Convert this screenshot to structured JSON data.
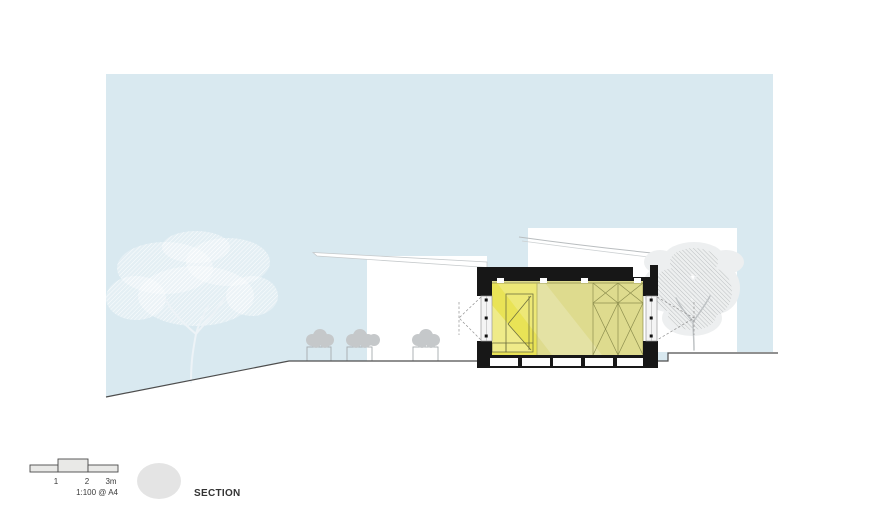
{
  "drawing": {
    "title_label": "SECTION",
    "type_note": "architectural cross-section drawing"
  },
  "scale_bar": {
    "ticks": [
      "1",
      "2",
      "3m"
    ],
    "note": "1:100 @ A4"
  },
  "colors": {
    "sky": "#d9e9f0",
    "interior_dull": "#dedb8e",
    "interior_bright": "#e9e356",
    "structure_black": "#171717",
    "elevation_white": "#ffffff",
    "ground_line": "#4d4d4d",
    "tree_hatch_gray": "#b6babc",
    "bush_gray": "#c5c8ca",
    "badge_circle": "#e4e4e4",
    "scale_fill": "#e9e9e7",
    "interior_linework": "#8d8e4e"
  }
}
